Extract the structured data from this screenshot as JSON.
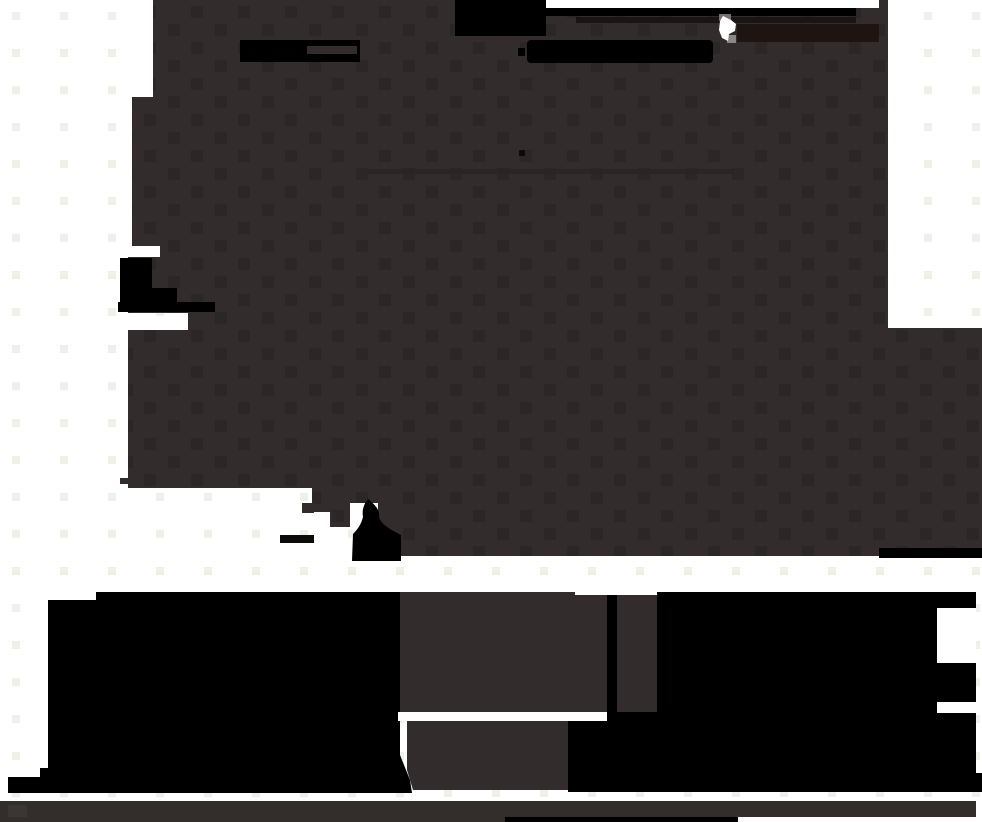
{
  "meta": {
    "width": 982,
    "height": 822,
    "background_color": "#ffffff"
  },
  "palette": {
    "white": "#ffffff",
    "foliage_gray": "#322d2c",
    "black": "#000000",
    "near_black": "#0d0b0a",
    "thin_bar_black": "#191514",
    "highlight_red_brown": "#1e1412",
    "seam_dark": "#2a2625",
    "texture_dot_dark": "#2b2726",
    "texture_dot_green": "#ecf2e8",
    "bottom_bar_gray": "#332d2c",
    "bar_light_square": "#3b3534",
    "cursor_white": "#ffffff",
    "cursor_gray_top": "#767170",
    "cursor_gray_bottom": "#8b8785"
  },
  "patterns": [
    {
      "id": "greenDots",
      "w": 48,
      "h": 37,
      "rects": [
        {
          "x": 12,
          "y": 12,
          "w": 8,
          "h": 8,
          "fill": "#ecf2e8"
        }
      ]
    },
    {
      "id": "darkDots",
      "w": 47,
      "h": 36,
      "rects": [
        {
          "x": 3,
          "y": 6,
          "w": 12,
          "h": 12,
          "fill": "#2b2726"
        },
        {
          "x": 27,
          "y": 24,
          "w": 12,
          "h": 12,
          "fill": "#2b2726"
        }
      ]
    }
  ],
  "scene": {
    "shapes": [
      {
        "name": "background",
        "type": "rect",
        "x": 0,
        "y": 0,
        "w": 982,
        "h": 822,
        "fill": "#ffffff"
      },
      {
        "name": "background-artifact-dots",
        "type": "rect",
        "x": 0,
        "y": 0,
        "w": 982,
        "h": 822,
        "fill": "pattern:greenDots"
      },
      {
        "name": "foliage-mass",
        "type": "polygon",
        "points": "153,0 546,0 546,8 879,8 879,0 888,0 888,328 982,328 982,556 401,556 401,503 350,503 350,527 330,527 330,512 312,512 312,488 128,488 128,484 120,484 120,478 128,478 128,330 188,330 188,313 128,313 128,257 160,257 160,246 132,246 132,97 153,97",
        "fill": "#322d2c"
      },
      {
        "name": "foliage-texture",
        "type": "polygon",
        "points": "153,0 546,0 546,8 879,8 879,0 888,0 888,328 982,328 982,556 401,556 401,503 350,503 350,527 330,527 330,512 312,512 312,488 128,488 128,484 120,484 120,478 128,478 128,330 188,330 188,313 128,313 128,257 160,257 160,246 132,246 132,97 153,97",
        "fill": "pattern:darkDots"
      },
      {
        "name": "horizontal-seam-line",
        "type": "rect",
        "x": 367,
        "y": 169,
        "w": 367,
        "h": 5,
        "fill": "#2a2625",
        "opacity": 0.85
      },
      {
        "name": "top-black-patch",
        "type": "rect",
        "x": 455,
        "y": 0,
        "w": 91,
        "h": 36,
        "fill": "#000000"
      },
      {
        "name": "top-black-bar",
        "type": "rect",
        "x": 496,
        "y": 8,
        "w": 360,
        "h": 8,
        "fill": "#000000"
      },
      {
        "name": "top-thin-bar",
        "type": "rect",
        "x": 576,
        "y": 17,
        "w": 280,
        "h": 6,
        "fill": "#191514"
      },
      {
        "name": "highlight-red-bar",
        "type": "rect",
        "x": 737,
        "y": 24,
        "w": 142,
        "h": 18,
        "fill": "#1e1412"
      },
      {
        "name": "black-pill",
        "type": "rect",
        "x": 527,
        "y": 40,
        "w": 186,
        "h": 23,
        "rx": 4,
        "fill": "#000000"
      },
      {
        "name": "pill-left-dash",
        "type": "rect",
        "x": 518,
        "y": 48,
        "w": 7,
        "h": 8,
        "fill": "#000000"
      },
      {
        "name": "left-black-rect",
        "type": "rect",
        "x": 240,
        "y": 40,
        "w": 120,
        "h": 22,
        "fill": "#000000"
      },
      {
        "name": "left-rect-notch",
        "type": "rect",
        "x": 307,
        "y": 46,
        "w": 50,
        "h": 8,
        "fill": "#322d2c"
      },
      {
        "name": "tiny-mark",
        "type": "rect",
        "x": 519,
        "y": 150,
        "w": 6,
        "h": 6,
        "fill": "#0d0b0a"
      },
      {
        "name": "left-edge-blob-upper",
        "type": "rect",
        "x": 120,
        "y": 258,
        "w": 32,
        "h": 30,
        "fill": "#000000"
      },
      {
        "name": "left-edge-blob-middle",
        "type": "rect",
        "x": 120,
        "y": 288,
        "w": 57,
        "h": 14,
        "fill": "#000000"
      },
      {
        "name": "left-edge-blob-lower",
        "type": "rect",
        "x": 118,
        "y": 302,
        "w": 97,
        "h": 10,
        "fill": "#000000"
      },
      {
        "name": "foliage-step-dash",
        "type": "rect",
        "x": 302,
        "y": 503,
        "w": 12,
        "h": 10,
        "fill": "#322d2c"
      },
      {
        "name": "floating-dash",
        "type": "rect",
        "x": 280,
        "y": 535,
        "w": 34,
        "h": 8,
        "fill": "#0d0b0a"
      },
      {
        "name": "foliage-neck-fill",
        "type": "rect",
        "x": 378,
        "y": 503,
        "w": 23,
        "h": 33,
        "fill": "#322d2c"
      },
      {
        "name": "trunk-silhouette",
        "type": "path",
        "d": "M368,499 C363,505 362,511 363,517 C361,525 357,530 353,534 L352,561 L401,561 L401,535 C392,530 381,525 379,517 C380,509 374,504 368,499 Z",
        "fill": "#000000"
      },
      {
        "name": "foliage-bottom-black-band",
        "type": "rect",
        "x": 879,
        "y": 548,
        "w": 103,
        "h": 10,
        "fill": "#000000"
      },
      {
        "name": "hedge-black-left",
        "type": "polygon",
        "points": "96,592 400,592 400,755 410,780 412,793 8,793 8,777 40,777 40,768 48,768 48,600 96,600",
        "fill": "#000000"
      },
      {
        "name": "hedge-gray-upper",
        "type": "polygon",
        "points": "400,592 575,592 575,595 657,595 657,712 400,712",
        "fill": "#322d2c"
      },
      {
        "name": "hedge-black-strip",
        "type": "rect",
        "x": 607,
        "y": 595,
        "w": 10,
        "h": 117,
        "fill": "#000000"
      },
      {
        "name": "hedge-white-band",
        "type": "rect",
        "x": 398,
        "y": 712,
        "w": 209,
        "h": 9,
        "fill": "#ffffff"
      },
      {
        "name": "hedge-gray-lower",
        "type": "polygon",
        "points": "407,721 568,721 568,790 413,790 407,770",
        "fill": "#322d2c"
      },
      {
        "name": "hedge-black-right",
        "type": "polygon",
        "points": "657,592 976,592 976,773 982,773 982,792 568,792 568,721 607,721 607,712 657,712",
        "fill": "#000000"
      },
      {
        "name": "hedge-white-hole-upper",
        "type": "rect",
        "x": 937,
        "y": 608,
        "w": 39,
        "h": 55,
        "fill": "#ffffff"
      },
      {
        "name": "hedge-white-hole-lower",
        "type": "rect",
        "x": 937,
        "y": 702,
        "w": 45,
        "h": 11,
        "fill": "#ffffff"
      },
      {
        "name": "bottom-bar",
        "type": "rect",
        "x": 0,
        "y": 801,
        "w": 976,
        "h": 16,
        "fill": "#332d2c"
      },
      {
        "name": "bottom-bar-left-extension",
        "type": "rect",
        "x": 0,
        "y": 815,
        "w": 505,
        "h": 7,
        "fill": "#332d2c"
      },
      {
        "name": "bottom-black-strip",
        "type": "rect",
        "x": 505,
        "y": 817,
        "w": 233,
        "h": 5,
        "fill": "#000000"
      },
      {
        "name": "bottom-bar-light-square",
        "type": "rect",
        "x": 8,
        "y": 805,
        "w": 19,
        "h": 12,
        "fill": "#3b3534"
      },
      {
        "name": "cursor-shadow-top",
        "type": "rect",
        "x": 719,
        "y": 14,
        "w": 12,
        "h": 7,
        "fill": "#767170"
      },
      {
        "name": "cursor-shadow-bottom",
        "type": "rect",
        "x": 727,
        "y": 35,
        "w": 9,
        "h": 8,
        "fill": "#8b8785"
      },
      {
        "name": "mouse-cursor",
        "type": "polygon",
        "points": "723,16 731,20 736,24 735,31 729,34 728,41 722,38 719,30 720,21",
        "fill": "#ffffff"
      }
    ]
  }
}
